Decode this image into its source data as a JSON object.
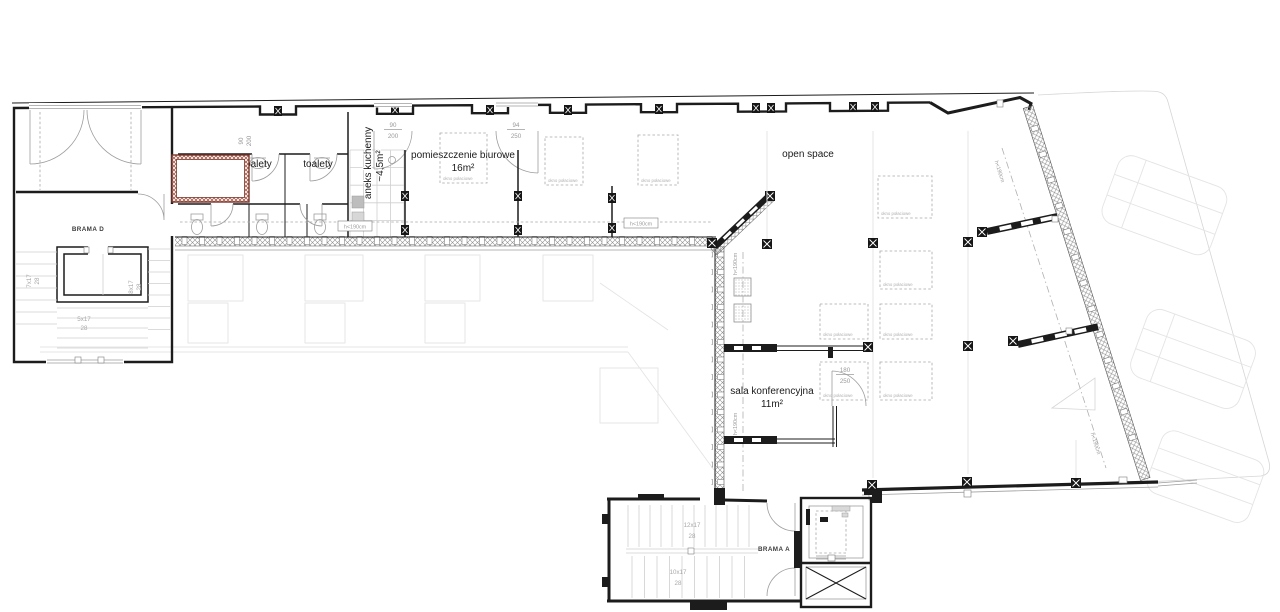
{
  "plan": {
    "labels": {
      "toilets": "toalety",
      "kitchen": "aneks kuchenny",
      "kitchen_area": "~4,5m²",
      "office": "pomieszczenie biurowe",
      "office_area": "16m²",
      "open_space": "open space",
      "conference": "sala konferencyjna",
      "conference_area": "11m²",
      "gate_d": "BRAMA D",
      "gate_a": "BRAMA A",
      "skylight": "okno połaciowe",
      "height_limit": "h<190cm"
    },
    "dimensions": {
      "d90": "90",
      "d200": "200",
      "d94": "94",
      "d250": "250",
      "d180": "180"
    },
    "stairs": {
      "f7": "7x17",
      "f8": "8x17",
      "f5": "5x17",
      "f12": "12x17",
      "f10": "10x17",
      "riser": "28"
    },
    "colors": {
      "wall": "#1c1c1c",
      "accent_red": "#7a362a",
      "dim_grey": "#9b9b9b",
      "faint_grey": "#e0e0e0"
    }
  }
}
